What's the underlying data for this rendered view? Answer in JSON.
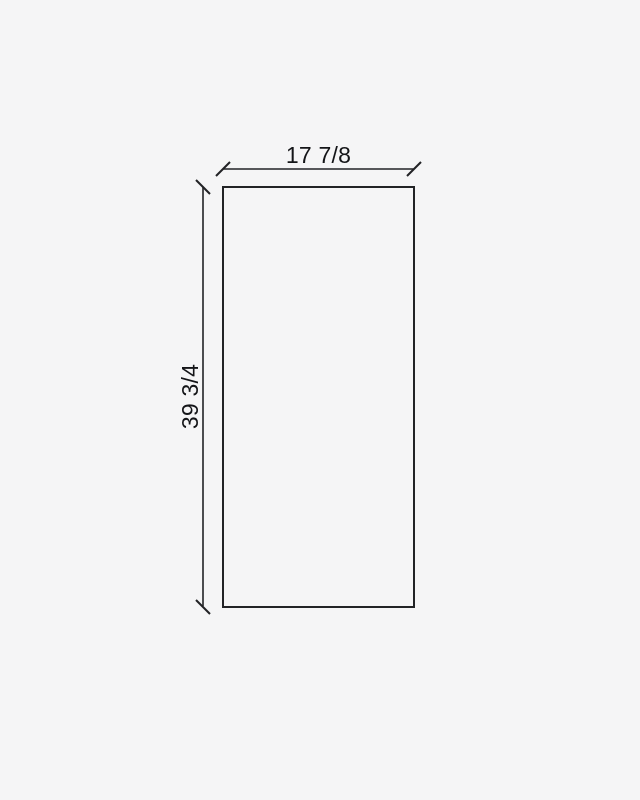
{
  "drawing": {
    "width_label": "17 7/8",
    "height_label": "39 3/4",
    "colors": {
      "background": "#f5f5f6",
      "line": "#222326",
      "text": "#141518"
    }
  }
}
